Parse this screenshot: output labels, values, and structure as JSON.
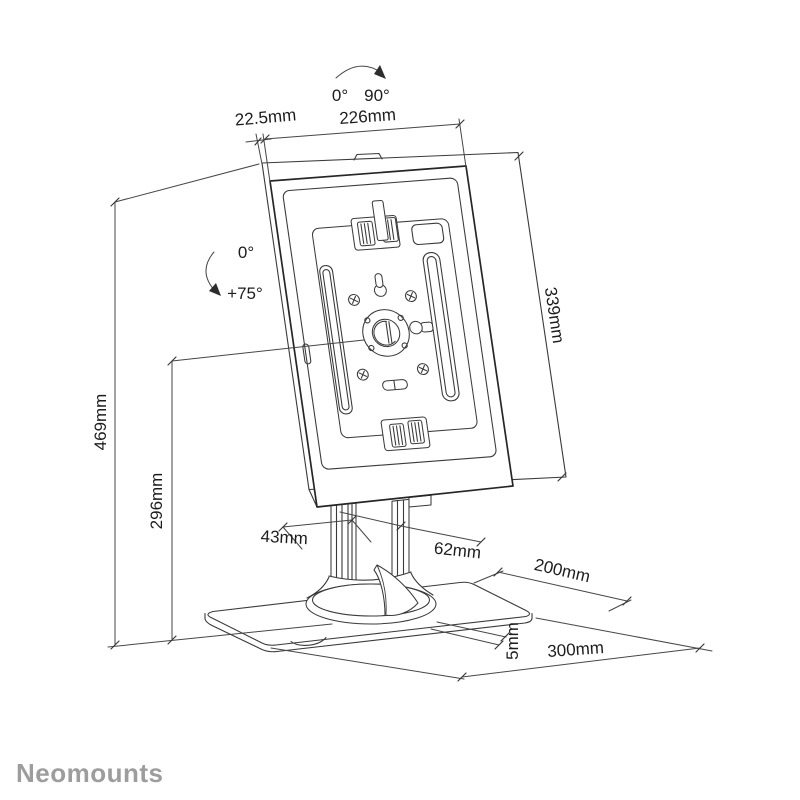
{
  "brand": {
    "logo_text": "Neomounts",
    "logo_color": "#9d9d9d"
  },
  "colors": {
    "line": "#3a3a3a",
    "outline": "#262626",
    "dimension": "#464646",
    "text": "#1c1c1c",
    "background": "#ffffff"
  },
  "annotations": {
    "rotation_arc": {
      "left": "0°",
      "right": "90°"
    },
    "tilt_arc": {
      "top": "0°",
      "bottom": "+75°"
    },
    "dims": {
      "enclosure_depth": "22.5mm",
      "enclosure_width": "226mm",
      "enclosure_height": "339mm",
      "total_height": "469mm",
      "pivot_height": "296mm",
      "pole_depth": "43mm",
      "pole_width": "62mm",
      "base_width": "200mm",
      "base_thickness": "5mm",
      "base_depth": "300mm"
    }
  }
}
